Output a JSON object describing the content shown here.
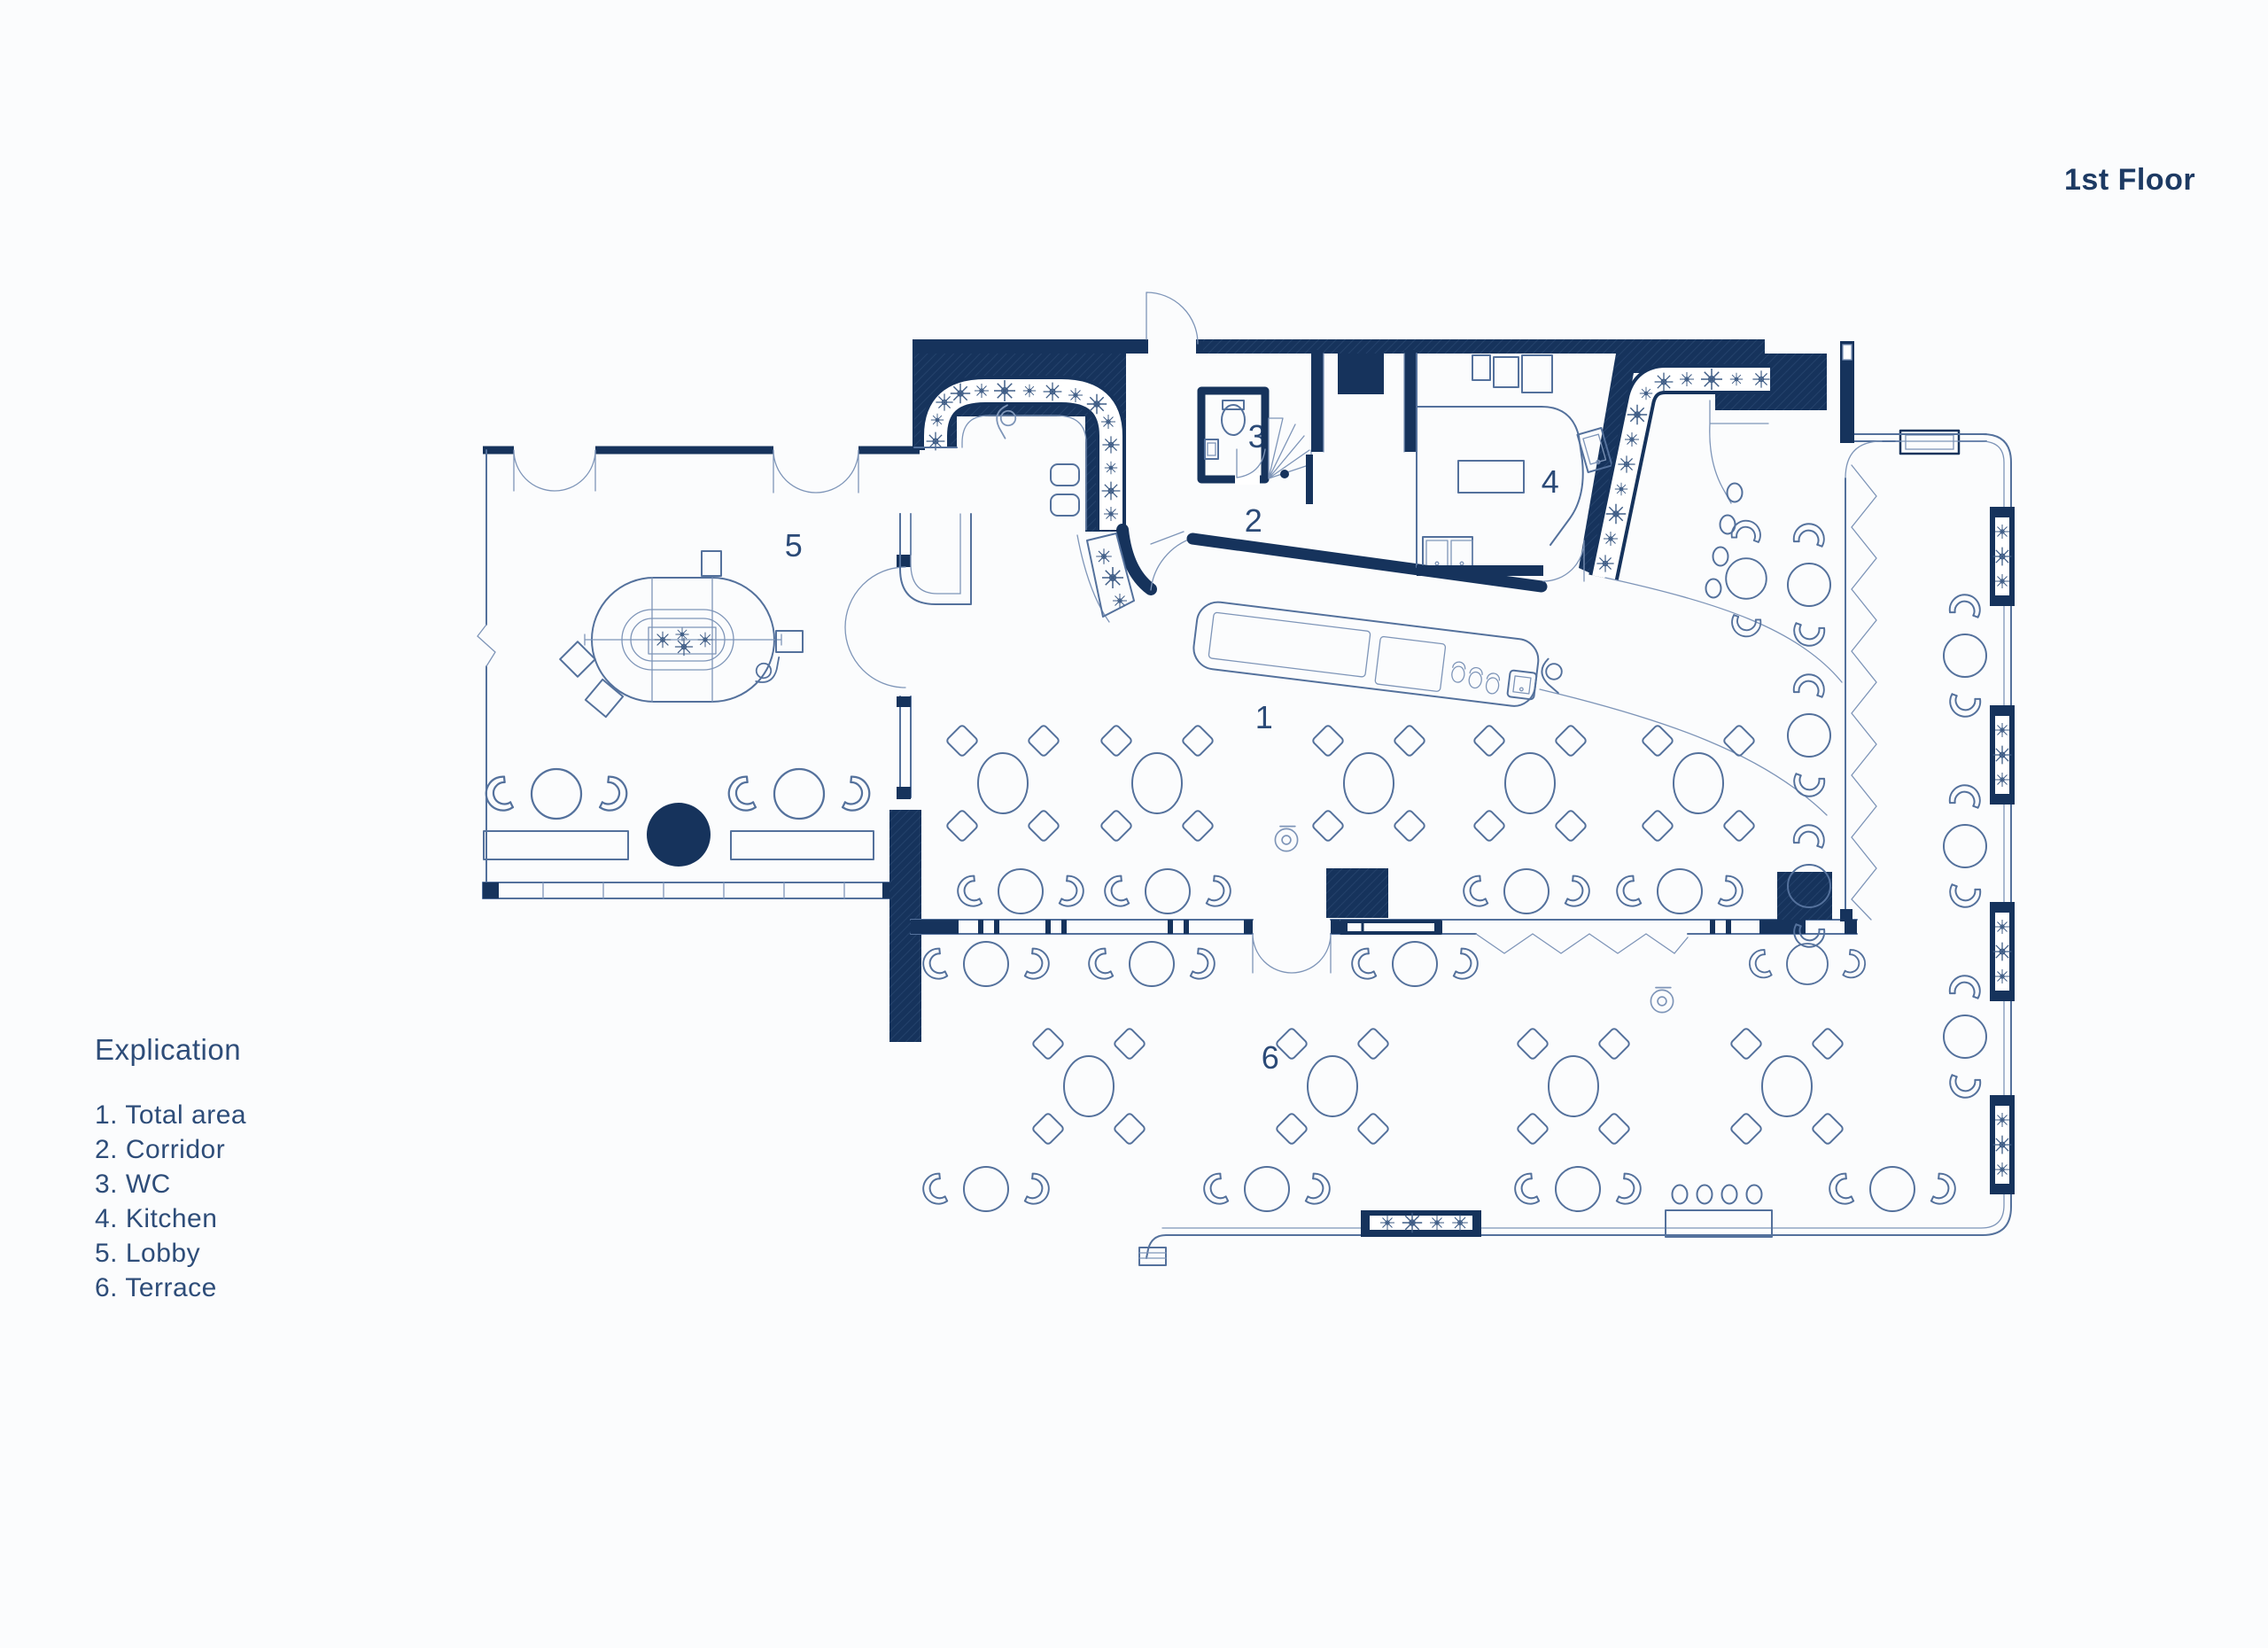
{
  "title": "1st Floor",
  "legend": {
    "title": "Explication",
    "items": [
      "1. Total area",
      "2. Corridor",
      "3. WC",
      "4. Kitchen",
      "5. Lobby",
      "6. Terrace"
    ]
  },
  "plan_labels": {
    "l1": "1",
    "l2": "2",
    "l3": "3",
    "l4": "4",
    "l5": "5",
    "l6": "6"
  },
  "rooms": [
    {
      "number": "1",
      "name": "Total area"
    },
    {
      "number": "2",
      "name": "Corridor"
    },
    {
      "number": "3",
      "name": "WC"
    },
    {
      "number": "4",
      "name": "Kitchen"
    },
    {
      "number": "5",
      "name": "Lobby"
    },
    {
      "number": "6",
      "name": "Terrace"
    }
  ],
  "colors": {
    "wall_navy": "#16335c",
    "line_blue": "#54719c",
    "light_line": "#7e95b8",
    "text_blue": "#2b4a77",
    "background": "#fbfcfd"
  }
}
